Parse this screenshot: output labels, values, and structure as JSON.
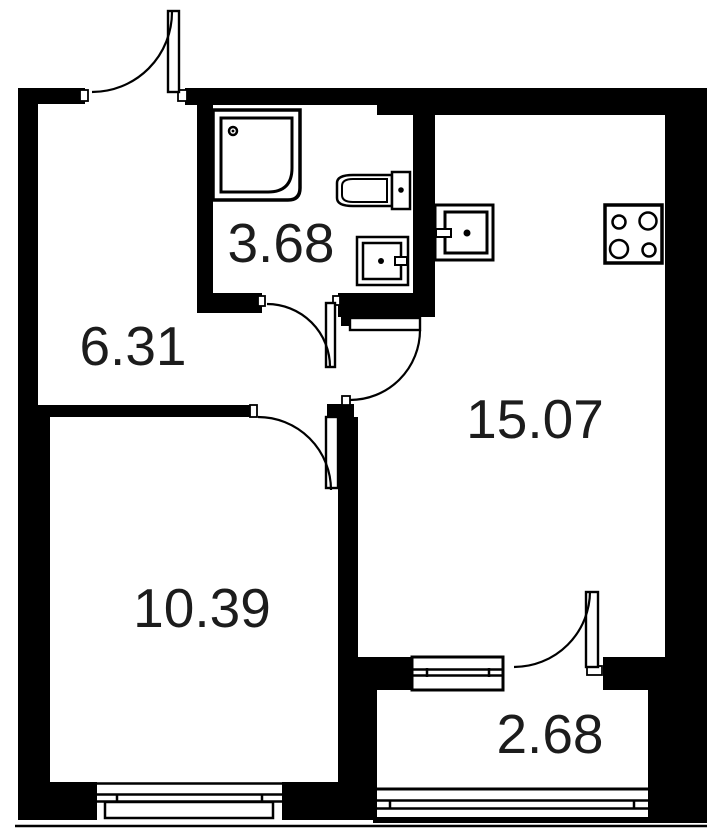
{
  "plan": {
    "canvas": {
      "w": 719,
      "h": 831,
      "bg": "#ffffff",
      "ink": "#000000"
    },
    "rooms": [
      {
        "id": "bathroom",
        "area": "3.68",
        "cx": 281,
        "cy": 262
      },
      {
        "id": "hallway",
        "area": "6.31",
        "cx": 133,
        "cy": 365
      },
      {
        "id": "bedroom",
        "area": "10.39",
        "cx": 202,
        "cy": 627
      },
      {
        "id": "living-kitchen",
        "area": "15.07",
        "cx": 535,
        "cy": 438
      },
      {
        "id": "balcony",
        "area": "2.68",
        "cx": 550,
        "cy": 753
      }
    ],
    "shapes": [
      {
        "name": "wall-top-left",
        "type": "rect",
        "x": 18,
        "y": 88,
        "w": 67,
        "h": 16,
        "fill": "#000000"
      },
      {
        "name": "wall-top-main",
        "type": "rect",
        "x": 185,
        "y": 88,
        "w": 480,
        "h": 17,
        "fill": "#000000"
      },
      {
        "name": "wall-top-kitchen-step",
        "type": "rect",
        "x": 377,
        "y": 88,
        "w": 288,
        "h": 27,
        "fill": "#000000"
      },
      {
        "name": "wall-right",
        "type": "rect",
        "x": 665,
        "y": 88,
        "w": 42,
        "h": 569,
        "fill": "#000000"
      },
      {
        "name": "wall-right-balcony",
        "type": "rect",
        "x": 648,
        "y": 657,
        "w": 59,
        "h": 166,
        "fill": "#000000"
      },
      {
        "name": "wall-left-upper",
        "type": "rect",
        "x": 18,
        "y": 88,
        "w": 20,
        "h": 317,
        "fill": "#000000"
      },
      {
        "name": "wall-left-lower",
        "type": "rect",
        "x": 18,
        "y": 405,
        "w": 32,
        "h": 415,
        "fill": "#000000"
      },
      {
        "name": "wall-bottom-west",
        "type": "rect",
        "x": 18,
        "y": 782,
        "w": 79,
        "h": 38,
        "fill": "#000000"
      },
      {
        "name": "wall-bottom-east",
        "type": "rect",
        "x": 282,
        "y": 782,
        "w": 95,
        "h": 38,
        "fill": "#000000"
      },
      {
        "name": "wall-bath-left",
        "type": "rect",
        "x": 197,
        "y": 88,
        "w": 16,
        "h": 225,
        "fill": "#000000"
      },
      {
        "name": "wall-bath-bottom-left",
        "type": "rect",
        "x": 197,
        "y": 293,
        "w": 65,
        "h": 20,
        "fill": "#000000"
      },
      {
        "name": "wall-bath-right",
        "type": "rect",
        "x": 413,
        "y": 88,
        "w": 22,
        "h": 229,
        "fill": "#000000"
      },
      {
        "name": "wall-bath-bottom-right",
        "type": "rect",
        "x": 338,
        "y": 293,
        "w": 97,
        "h": 24,
        "fill": "#000000"
      },
      {
        "name": "wall-hall-bedroom",
        "type": "rect",
        "x": 38,
        "y": 405,
        "w": 212,
        "h": 12,
        "fill": "#000000"
      },
      {
        "name": "wall-bedroom-door-hinge",
        "type": "rect",
        "x": 327,
        "y": 404,
        "w": 27,
        "h": 13,
        "fill": "#000000"
      },
      {
        "name": "wall-kitchen-door-hinge",
        "type": "rect",
        "x": 341,
        "y": 315,
        "w": 11,
        "h": 11,
        "fill": "#000000"
      },
      {
        "name": "wall-bedroom-kitchen",
        "type": "rect",
        "x": 338,
        "y": 417,
        "w": 20,
        "h": 273,
        "fill": "#000000"
      },
      {
        "name": "wall-balcony-left-corner",
        "type": "rect",
        "x": 338,
        "y": 690,
        "w": 39,
        "h": 130,
        "fill": "#000000"
      },
      {
        "name": "wall-balcony-part-west",
        "type": "rect",
        "x": 358,
        "y": 657,
        "w": 54,
        "h": 33,
        "fill": "#000000"
      },
      {
        "name": "wall-balcony-part-east",
        "type": "rect",
        "x": 603,
        "y": 657,
        "w": 45,
        "h": 33,
        "fill": "#000000"
      },
      {
        "name": "door-jamb-entry-left",
        "type": "rect",
        "x": 80,
        "y": 90,
        "w": 8,
        "h": 11,
        "fill": "#ffffff",
        "stroke": "#000000",
        "sw": 1.8
      },
      {
        "name": "door-jamb-entry-right",
        "type": "rect",
        "x": 178,
        "y": 90,
        "w": 9,
        "h": 11,
        "fill": "#ffffff",
        "stroke": "#000000",
        "sw": 1.8
      },
      {
        "name": "door-jamb-bath-left",
        "type": "rect",
        "x": 258,
        "y": 296,
        "w": 7,
        "h": 10,
        "fill": "#ffffff",
        "stroke": "#000000",
        "sw": 1.8
      },
      {
        "name": "door-jamb-bath-right",
        "type": "rect",
        "x": 333,
        "y": 296,
        "w": 7,
        "h": 9,
        "fill": "#ffffff",
        "stroke": "#000000",
        "sw": 1.8
      },
      {
        "name": "door-jamb-kitchen",
        "type": "rect",
        "x": 342,
        "y": 396,
        "w": 8,
        "h": 9,
        "fill": "#ffffff",
        "stroke": "#000000",
        "sw": 1.8
      },
      {
        "name": "door-jamb-bedroom",
        "type": "rect",
        "x": 250,
        "y": 405,
        "w": 7,
        "h": 12,
        "fill": "#ffffff",
        "stroke": "#000000",
        "sw": 1.8
      },
      {
        "name": "door-jamb-balcony",
        "type": "rect",
        "x": 587,
        "y": 666,
        "w": 15,
        "h": 9,
        "fill": "#ffffff",
        "stroke": "#000000",
        "sw": 1.8
      },
      {
        "name": "window-bedroom-face-line",
        "type": "line",
        "x1": 97,
        "y1": 783.5,
        "x2": 282,
        "y2": 783.5,
        "sw": 2.5
      },
      {
        "name": "window-bedroom-glass-1",
        "type": "line",
        "x1": 97,
        "y1": 794.5,
        "x2": 282,
        "y2": 794.5,
        "sw": 2.5
      },
      {
        "name": "window-bedroom-glass-2",
        "type": "line",
        "x1": 97,
        "y1": 801.5,
        "x2": 282,
        "y2": 801.5,
        "sw": 2.5
      },
      {
        "name": "window-bedroom-tick-left",
        "type": "line",
        "x1": 117,
        "y1": 794,
        "x2": 117,
        "y2": 802,
        "sw": 2.5
      },
      {
        "name": "window-bedroom-tick-right",
        "type": "line",
        "x1": 262,
        "y1": 794,
        "x2": 262,
        "y2": 802,
        "sw": 2.5
      },
      {
        "name": "window-bedroom-sill",
        "type": "rect",
        "x": 105,
        "y": 802,
        "w": 168,
        "h": 16,
        "fill": "#ffffff",
        "stroke": "#000000",
        "sw": 2.5
      },
      {
        "name": "window-balcony-frame",
        "type": "rect",
        "x": 412,
        "y": 657,
        "w": 91,
        "h": 33,
        "fill": "#ffffff",
        "stroke": "#000000",
        "sw": 3
      },
      {
        "name": "window-balcony-glass-1",
        "type": "line",
        "x1": 412,
        "y1": 669.5,
        "x2": 503,
        "y2": 669.5,
        "sw": 2.5
      },
      {
        "name": "window-balcony-glass-2",
        "type": "line",
        "x1": 412,
        "y1": 675.5,
        "x2": 503,
        "y2": 675.5,
        "sw": 2.5
      },
      {
        "name": "window-balcony-tick-left",
        "type": "line",
        "x1": 427,
        "y1": 668,
        "x2": 427,
        "y2": 677,
        "sw": 2.5
      },
      {
        "name": "window-balcony-tick-right",
        "type": "line",
        "x1": 489,
        "y1": 668,
        "x2": 489,
        "y2": 677,
        "sw": 2.5
      },
      {
        "name": "railing-balcony-inner",
        "type": "line",
        "x1": 373,
        "y1": 789,
        "x2": 648,
        "y2": 789,
        "sw": 3
      },
      {
        "name": "railing-balcony-glass-1",
        "type": "line",
        "x1": 373,
        "y1": 800.5,
        "x2": 648,
        "y2": 800.5,
        "sw": 2.5
      },
      {
        "name": "railing-balcony-glass-2",
        "type": "line",
        "x1": 373,
        "y1": 808.5,
        "x2": 648,
        "y2": 808.5,
        "sw": 2.5
      },
      {
        "name": "railing-balcony-tick-left",
        "type": "line",
        "x1": 390,
        "y1": 800,
        "x2": 390,
        "y2": 809,
        "sw": 2.5
      },
      {
        "name": "railing-balcony-tick-right",
        "type": "line",
        "x1": 634,
        "y1": 800,
        "x2": 634,
        "y2": 809,
        "sw": 2.5
      },
      {
        "name": "railing-balcony-slab",
        "type": "rect",
        "x": 373,
        "y": 817,
        "w": 275,
        "h": 6,
        "fill": "#000000"
      },
      {
        "name": "facade-line",
        "type": "line",
        "x1": 15,
        "y1": 826,
        "x2": 707,
        "y2": 826,
        "sw": 2.5
      },
      {
        "name": "shower-tray-outer",
        "type": "path",
        "d": "M 213 110 H 300 V 188 Q 300 200 288 200 H 213 Z",
        "fill": "#ffffff",
        "stroke": "#000000",
        "sw": 3.5
      },
      {
        "name": "shower-tray-inner",
        "type": "path",
        "d": "M 221 118 H 292 V 168 Q 292 192 268 192 H 221 Z",
        "fill": "none",
        "stroke": "#000000",
        "sw": 3
      },
      {
        "name": "shower-drain-ring",
        "type": "circle",
        "cx": 233,
        "cy": 131,
        "r": 4,
        "fill": "#ffffff",
        "stroke": "#000000",
        "sw": 2.5
      },
      {
        "name": "shower-drain-dot",
        "type": "circle",
        "cx": 233,
        "cy": 131,
        "r": 1.4,
        "fill": "#000000"
      },
      {
        "name": "toilet-bowl-outer",
        "type": "path",
        "d": "M 392 175 H 353 Q 337 175 337 183 V 198 Q 337 206 353 206 H 392 Z",
        "fill": "#ffffff",
        "stroke": "#000000",
        "sw": 2.5
      },
      {
        "name": "toilet-bowl-inner",
        "type": "path",
        "d": "M 387 179 H 353 Q 342 179 342 186 V 195 Q 342 202 353 202 H 387 Z",
        "fill": "none",
        "stroke": "#000000",
        "sw": 2
      },
      {
        "name": "toilet-tank",
        "type": "rect",
        "x": 392,
        "y": 172,
        "w": 18,
        "h": 37,
        "fill": "#ffffff",
        "stroke": "#000000",
        "sw": 2.5
      },
      {
        "name": "toilet-tank-button",
        "type": "circle",
        "cx": 401,
        "cy": 190,
        "r": 2.8,
        "fill": "#000000"
      },
      {
        "name": "bath-sink-outer",
        "type": "rect",
        "x": 357,
        "y": 237,
        "w": 51,
        "h": 48,
        "fill": "#ffffff",
        "stroke": "#000000",
        "sw": 2.5
      },
      {
        "name": "bath-sink-inner",
        "type": "rect",
        "x": 363,
        "y": 243,
        "w": 38,
        "h": 36,
        "fill": "none",
        "stroke": "#000000",
        "sw": 2.5
      },
      {
        "name": "bath-sink-drain",
        "type": "circle",
        "cx": 381,
        "cy": 261,
        "r": 3,
        "fill": "#000000"
      },
      {
        "name": "bath-sink-tap",
        "type": "rect",
        "x": 395,
        "y": 257,
        "w": 12,
        "h": 8,
        "fill": "#ffffff",
        "stroke": "#000000",
        "sw": 2
      },
      {
        "name": "kitchen-sink-outer",
        "type": "rect",
        "x": 435,
        "y": 205,
        "w": 58,
        "h": 55,
        "fill": "#ffffff",
        "stroke": "#000000",
        "sw": 3
      },
      {
        "name": "kitchen-sink-inner",
        "type": "rect",
        "x": 445,
        "y": 212,
        "w": 42,
        "h": 41,
        "fill": "none",
        "stroke": "#000000",
        "sw": 3
      },
      {
        "name": "kitchen-sink-drain",
        "type": "circle",
        "cx": 467,
        "cy": 233,
        "r": 3.5,
        "fill": "#000000"
      },
      {
        "name": "kitchen-sink-tap",
        "type": "rect",
        "x": 436,
        "y": 229,
        "w": 15,
        "h": 8,
        "fill": "#ffffff",
        "stroke": "#000000",
        "sw": 2
      },
      {
        "name": "stove-body",
        "type": "rect",
        "x": 605,
        "y": 205,
        "w": 57,
        "h": 58,
        "fill": "#ffffff",
        "stroke": "#000000",
        "sw": 3.5
      },
      {
        "name": "stove-burner-tl",
        "type": "circle",
        "cx": 619,
        "cy": 222,
        "r": 6.5,
        "fill": "none",
        "stroke": "#000000",
        "sw": 2.5
      },
      {
        "name": "stove-burner-tr",
        "type": "circle",
        "cx": 648,
        "cy": 221,
        "r": 8.5,
        "fill": "none",
        "stroke": "#000000",
        "sw": 2.5
      },
      {
        "name": "stove-burner-bl",
        "type": "circle",
        "cx": 619,
        "cy": 249,
        "r": 9,
        "fill": "none",
        "stroke": "#000000",
        "sw": 2.5
      },
      {
        "name": "stove-burner-br",
        "type": "circle",
        "cx": 649,
        "cy": 250,
        "r": 6.5,
        "fill": "none",
        "stroke": "#000000",
        "sw": 2.5
      },
      {
        "name": "door-leaf-entry",
        "type": "rect",
        "x": 168,
        "y": 11,
        "w": 11,
        "h": 81,
        "fill": "#ffffff",
        "stroke": "#000000",
        "sw": 2.4
      },
      {
        "name": "door-swing-entry",
        "type": "path",
        "d": "M 92 92 A 80 80 0 0 0 172 12",
        "fill": "none",
        "stroke": "#000000",
        "sw": 2.2
      },
      {
        "name": "door-leaf-bath",
        "type": "rect",
        "x": 326,
        "y": 303,
        "w": 9,
        "h": 64,
        "fill": "#ffffff",
        "stroke": "#000000",
        "sw": 2.4
      },
      {
        "name": "door-swing-bath",
        "type": "path",
        "d": "M 267 304 A 63 63 0 0 1 330 367",
        "fill": "none",
        "stroke": "#000000",
        "sw": 2.2
      },
      {
        "name": "door-leaf-kitchen",
        "type": "rect",
        "x": 350,
        "y": 318,
        "w": 70,
        "h": 12,
        "fill": "#ffffff",
        "stroke": "#000000",
        "sw": 2.4
      },
      {
        "name": "door-swing-kitchen",
        "type": "path",
        "d": "M 420 330 A 70 70 0 0 1 350 400",
        "fill": "none",
        "stroke": "#000000",
        "sw": 2.2
      },
      {
        "name": "door-leaf-bedroom",
        "type": "rect",
        "x": 326,
        "y": 417,
        "w": 12,
        "h": 71,
        "fill": "#ffffff",
        "stroke": "#000000",
        "sw": 2.4
      },
      {
        "name": "door-swing-bedroom",
        "type": "path",
        "d": "M 258 417 A 73 73 0 0 1 331 490",
        "fill": "none",
        "stroke": "#000000",
        "sw": 2.2
      },
      {
        "name": "door-leaf-balcony",
        "type": "rect",
        "x": 586,
        "y": 592,
        "w": 12,
        "h": 75,
        "fill": "#ffffff",
        "stroke": "#000000",
        "sw": 2.4
      },
      {
        "name": "door-swing-balcony",
        "type": "path",
        "d": "M 514 667 A 76 76 0 0 0 590 591",
        "fill": "none",
        "stroke": "#000000",
        "sw": 2.2
      }
    ]
  }
}
